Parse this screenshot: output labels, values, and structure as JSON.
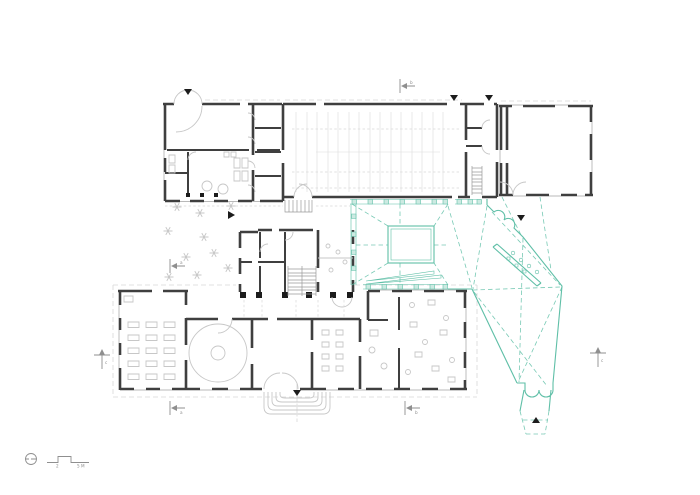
{
  "sheet": {
    "kind": "architectural floor plan drawing",
    "background": "#ffffff"
  },
  "colors": {
    "wall": "#3f3f3f",
    "detail": "#c7c7c7",
    "floor": "#d9d9d9",
    "sill": "#a2a2a2",
    "dashline": "#d8d8d8",
    "marker": "#8f8f8f",
    "arrow": "#1c1c1c",
    "teal": "#5fbfa7",
    "teal_fill": "#cdeae2"
  },
  "scale_bar": {
    "mid_label": "2",
    "end_label": "5 M"
  },
  "sections": {
    "a": "a",
    "b": "b",
    "c": "c"
  },
  "icons": {
    "north_symbol": "circle-with-tick north indicator",
    "entrance_marker": "small filled triangle",
    "section_marker": "tick line with filled arrowhead and letter label"
  }
}
